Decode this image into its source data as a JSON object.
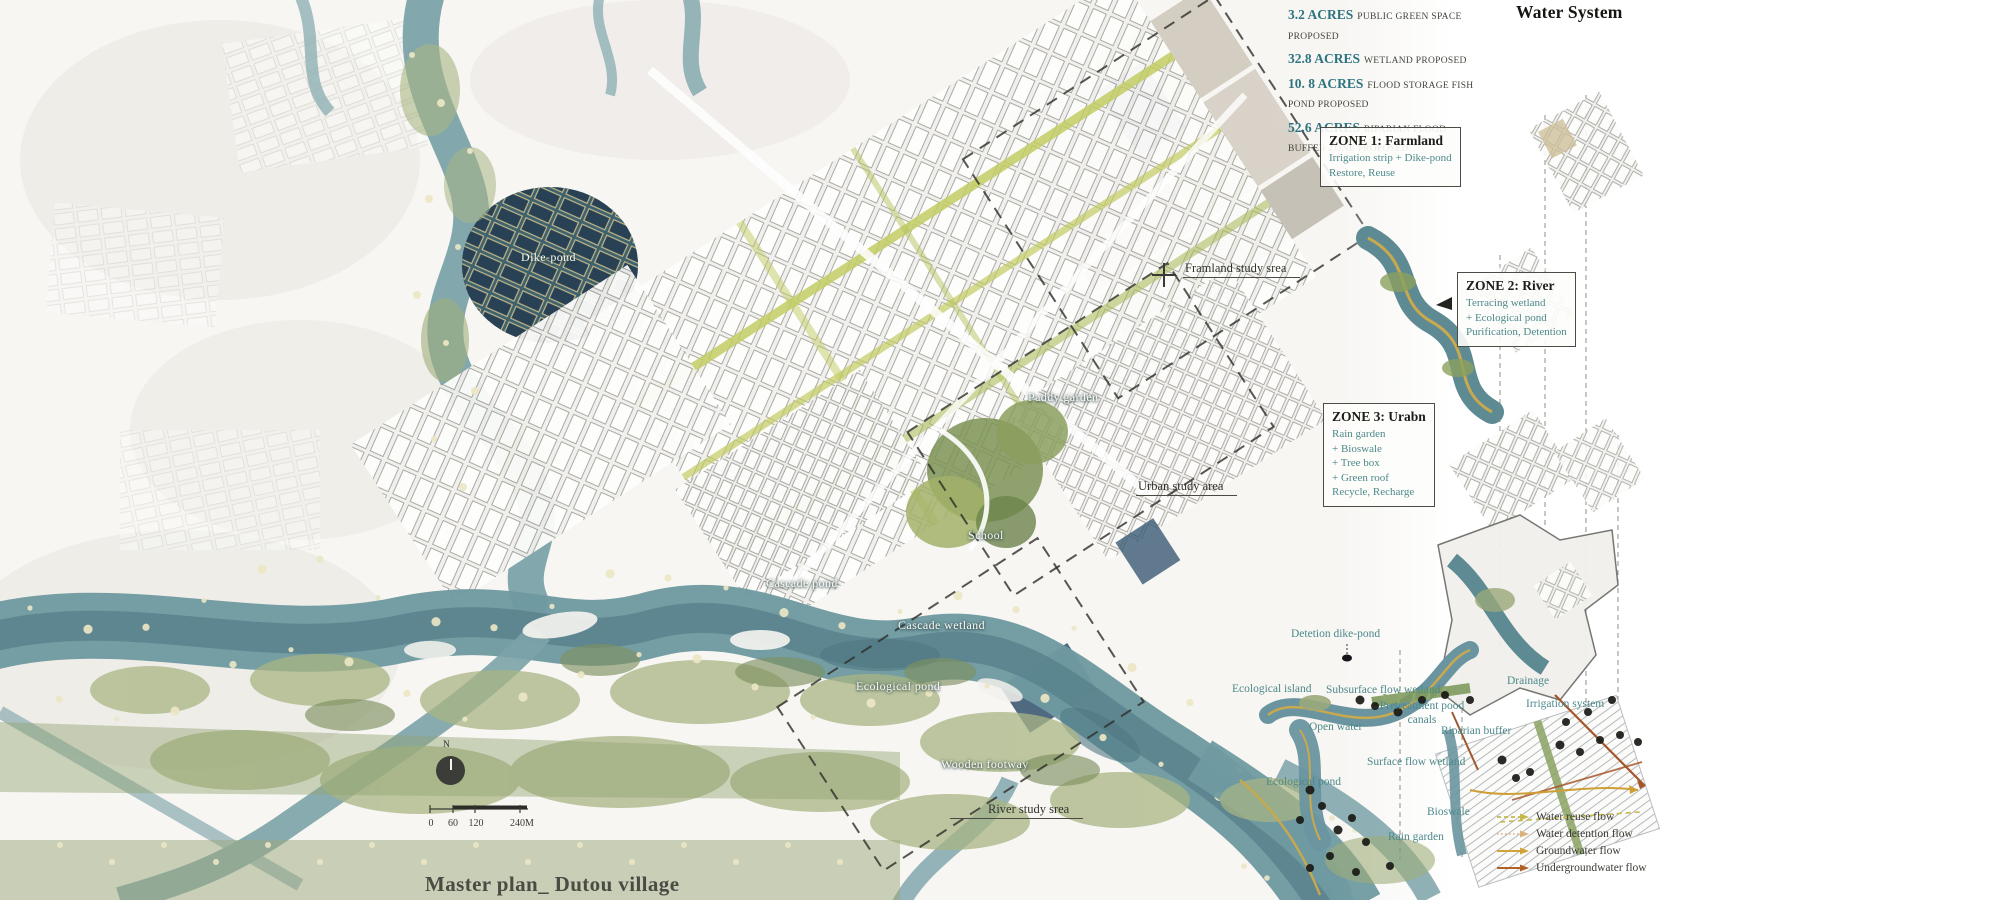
{
  "poster": {
    "title": "Master plan_ Dutou village",
    "section_title": "Water System"
  },
  "stats": [
    {
      "value": "3.2 ACRES",
      "label": "PUBLIC GREEN SPACE PROPOSED"
    },
    {
      "value": "32.8 ACRES",
      "label": "WETLAND PROPOSED"
    },
    {
      "value": "10. 8 ACRES",
      "label": "FLOOD STORAGE FISH POND PROPOSED"
    },
    {
      "value": "52.6 ACRES",
      "label": "RIPARIAN FLOOD BUFFER ZONE PROPOSED"
    }
  ],
  "zones": [
    {
      "title": "ZONE 1: Farmland",
      "lines": [
        "Irrigation strip + Dike-pond",
        "Restore, Reuse"
      ]
    },
    {
      "title": "ZONE 2: River",
      "lines": [
        "Terracing wetland",
        "+ Ecological pond",
        "Purification, Detention"
      ]
    },
    {
      "title": "ZONE 3: Urabn",
      "lines": [
        "Rain garden",
        "+ Bioswale",
        "+ Tree box",
        "+ Green roof",
        "Recycle, Recharge"
      ]
    }
  ],
  "map_labels": {
    "dike_pond": "Dike-pond",
    "framland_study": "Framland study srea",
    "paddy_garden": "Paddy garden",
    "urban_study": "Urban study area",
    "school": "School",
    "cascade_pond": "Cascade pond",
    "cascade_wetland": "Cascade wetland",
    "ecological_pond": "Ecological pond",
    "wooden_footway": "Wooden footway",
    "river_study": "River study srea"
  },
  "diagram_labels": {
    "detention_dike_pond": "Detetion dike-pond",
    "ecological_island": "Ecological island",
    "subsurface_flow_wetland": "Subsurface flow wetland",
    "open_water": "Open water",
    "pretreatment_line1": "Pretreatment pood",
    "pretreatment_line2": "canals",
    "riparian_buffer": "Riparian buffer",
    "drainage": "Drainage",
    "irrigation_system": "Irrigation system",
    "surface_flow_wetland": "Surface flow wetland",
    "ecological_pond": "Ecological pond",
    "bioswale": "Bioswale",
    "rain_garden": "Rain garden"
  },
  "legend": [
    {
      "label": "Water reuse flow",
      "color": "#c5b94e",
      "line_style": "dashed"
    },
    {
      "label": "Water detention flow",
      "color": "#dcaf7e",
      "line_style": "dotted"
    },
    {
      "label": "Groundwater flow",
      "color": "#d2a338",
      "line_style": "solid"
    },
    {
      "label": "Undergroundwater flow",
      "color": "#b06029",
      "line_style": "solid"
    }
  ],
  "north_label": "N",
  "scale_bar": {
    "ticks": [
      "0",
      "60",
      "120",
      "240M"
    ]
  },
  "colors": {
    "accent_teal": "#4d898b",
    "stat_value": "#2e7380",
    "river": "#76a0a6",
    "ink": "#3a3a35"
  }
}
